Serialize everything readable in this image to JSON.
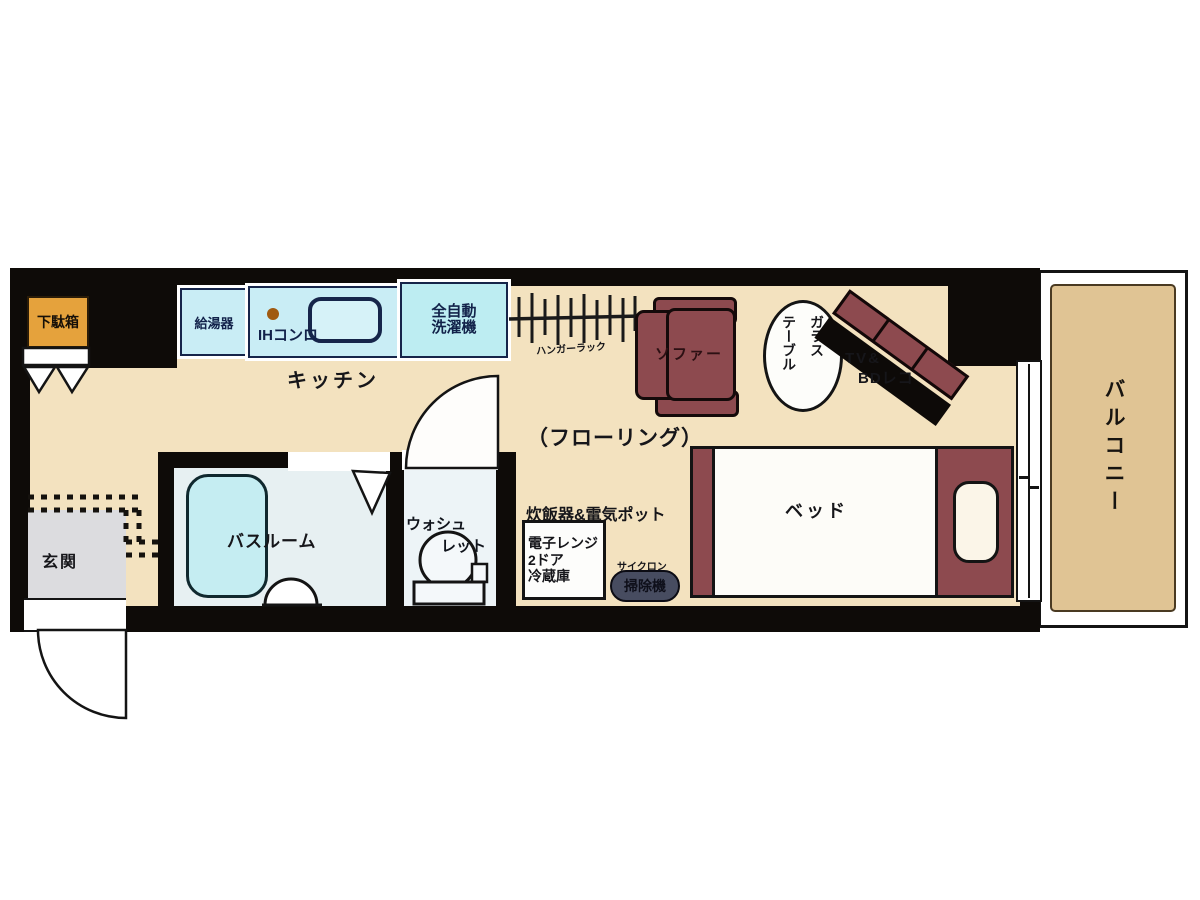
{
  "floorplan": {
    "rooms": {
      "kitchen": "キッチン",
      "flooring": "（フローリング）",
      "bathroom": "バスルーム",
      "toilet_line1": "ウォシュ",
      "toilet_line2": "レット",
      "entrance": "玄関",
      "balcony": "バルコニー"
    },
    "fixtures": {
      "shoe_box": "下駄箱",
      "water_heater": "給湯器",
      "ih_stove": "IHコンロ",
      "washer_line1": "全自動",
      "washer_line2": "洗濯機",
      "hanger_rack": "ハンガーラック",
      "sofa": "ソファー",
      "glass_table_col_right": "ガラス",
      "glass_table_col_left": "テーブル",
      "tv_line1": "TV&",
      "tv_line2": "BDレコ",
      "bed": "ベッド",
      "rice_cooker_pot": "炊飯器&電気ポット",
      "fridge_line1": "電子レンジ",
      "fridge_line2": "2ドア",
      "fridge_line3": "冷蔵庫",
      "vacuum_top": "サイクロン",
      "vacuum_bottom": "掃除機"
    },
    "colors": {
      "wall": "#0e0b08",
      "floor": "#f3e2bf",
      "balcony": "#e0c494",
      "appliance_blue": "#c9edf5",
      "washer_blue": "#bdedf2",
      "furniture_maroon": "#8d4a4f",
      "shoe_box_orange": "#e5a23c",
      "bathroom_floor": "#e7f0f2",
      "bathtub": "#c5edf2",
      "entrance_gray": "#dcdcdf"
    }
  }
}
